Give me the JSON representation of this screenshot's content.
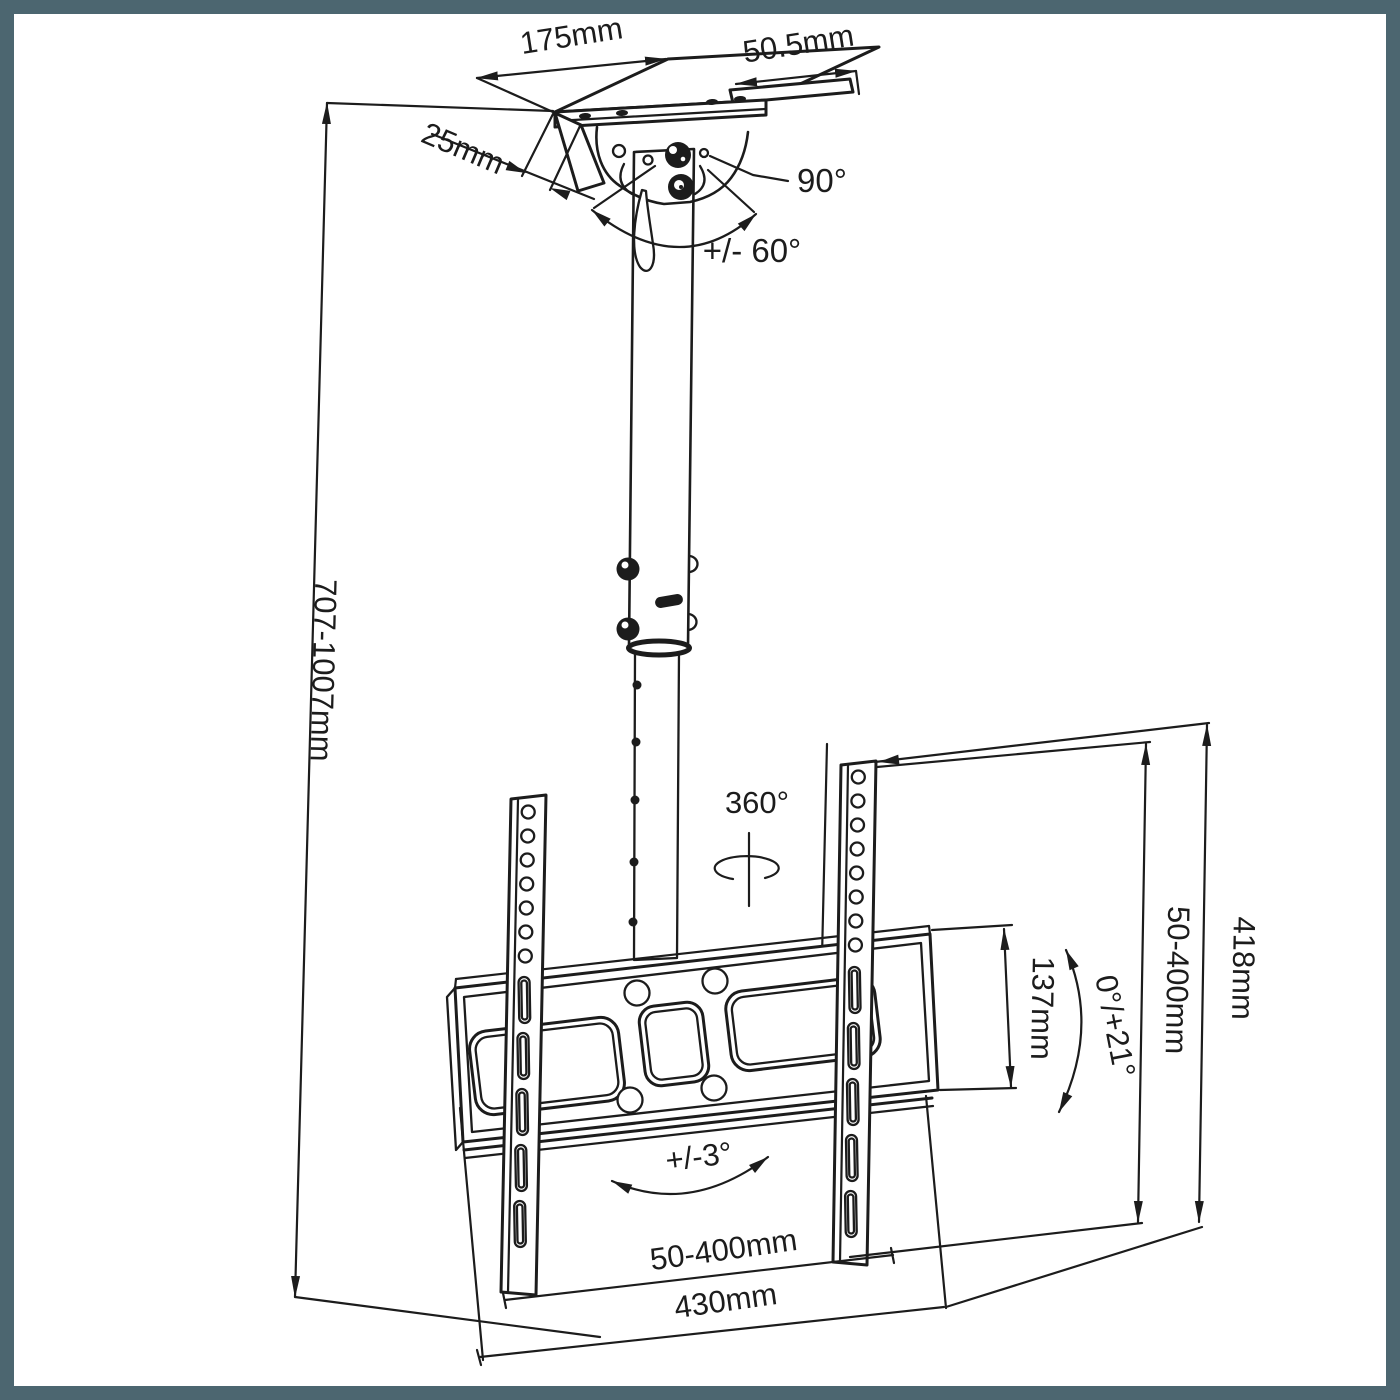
{
  "app": {
    "title": "TV ceiling mount bracket technical drawing"
  },
  "canvas": {
    "background": "#ffffff",
    "border_color": "#4c6670",
    "line_color": "#1c1c1c",
    "border_width_px": 14
  },
  "dimensions": {
    "plate_width": "175mm",
    "plate_side": "50.5mm",
    "plate_lip": "25mm",
    "swivel_angle": "90°",
    "tilt_range": "+/- 60°",
    "pole_height_range": "707-1007mm",
    "rotation": "360°",
    "vesa_vertical_range": "50-400mm",
    "bracket_height": "418mm",
    "plate_height": "137mm",
    "tilt_up_range": "0°/+21°",
    "level_adjustment": "+/-3°",
    "vesa_horizontal_range": "50-400mm",
    "bracket_width": "430mm"
  },
  "parts": {
    "ceiling_plate": "ceiling mounting plate",
    "tilt_bracket": "pivot tilt bracket",
    "pole": "telescopic pole",
    "vesa_plate": "VESA mounting plate",
    "left_rail": "left VESA rail",
    "right_rail": "right VESA rail"
  }
}
